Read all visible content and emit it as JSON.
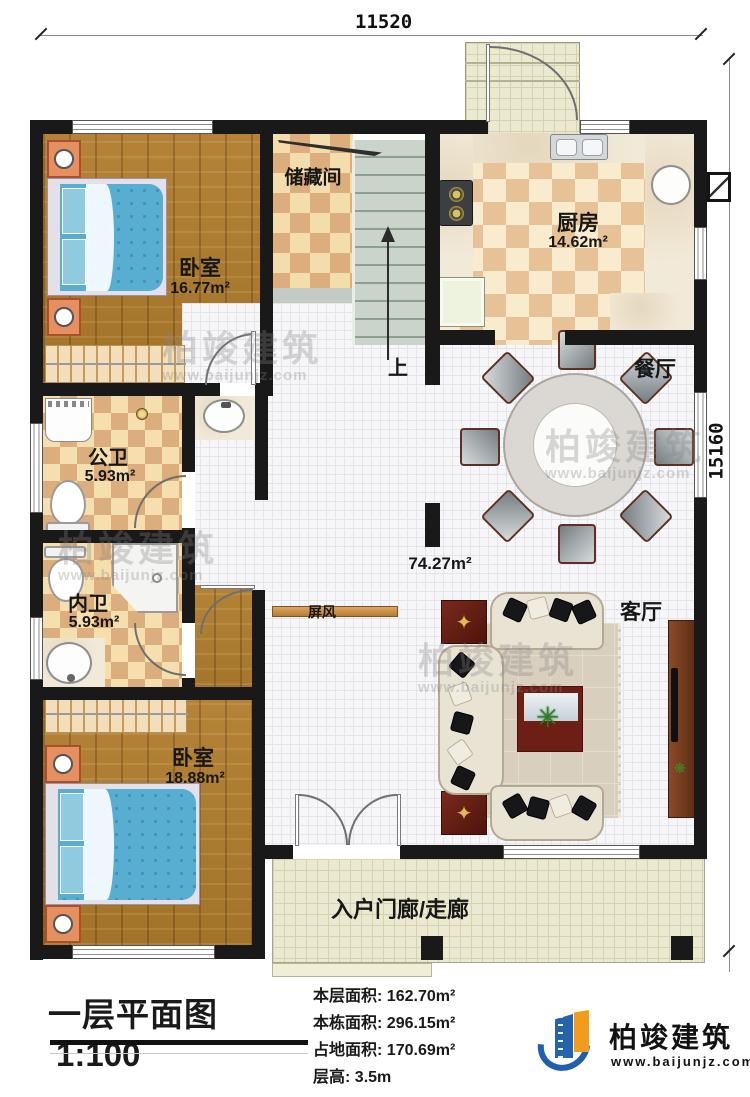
{
  "dimensions": {
    "width": "11520",
    "height": "15160"
  },
  "rooms": {
    "bedroom1": {
      "name": "卧室",
      "area": "16.77m²"
    },
    "storage": {
      "name": "储藏间"
    },
    "kitchen": {
      "name": "厨房",
      "area": "14.62m²"
    },
    "dining": {
      "name": "餐厅"
    },
    "hall_area": "74.27m²",
    "bath_public": {
      "name": "公卫",
      "area": "5.93m²"
    },
    "bath_private": {
      "name": "内卫",
      "area": "5.93m²"
    },
    "bedroom2": {
      "name": "卧室",
      "area": "18.88m²"
    },
    "living": {
      "name": "客厅"
    },
    "screen_label": "屏风",
    "stairs_up": "上",
    "porch": "入户门廊/走廊"
  },
  "titleblock": {
    "title": "一层平面图",
    "scale": "1:100",
    "stats": [
      {
        "label": "本层面积:",
        "value": "162.70m²"
      },
      {
        "label": "本栋面积:",
        "value": "296.15m²"
      },
      {
        "label": "占地面积:",
        "value": "170.69m²"
      },
      {
        "label": "层高:",
        "value": "3.5m"
      }
    ]
  },
  "logo": {
    "name": "柏竣建筑",
    "url": "www.baijunjz.com"
  },
  "watermark": {
    "line1": "柏竣建筑",
    "line2": "www.baijunjz.com"
  },
  "colors": {
    "wall": "#191919",
    "wood": "#b48338",
    "tile_warm": "#dcae7e",
    "tile_white": "#f6f6f8",
    "porch": "#ebe9cf",
    "accent_blue": "#1f5fae",
    "accent_orange": "#f39b1d",
    "bed_blue": "#58aed0"
  }
}
